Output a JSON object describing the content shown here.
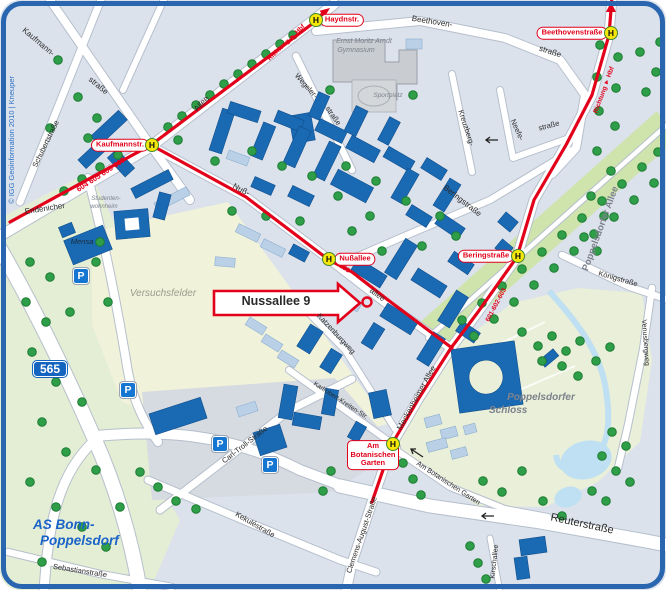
{
  "map": {
    "copyright": "© IGG Geoinformation 2010 | Kneuper",
    "callout": "Nussallee 9",
    "shield_565": "565",
    "h": "H",
    "parking": "P",
    "junction": [
      "AS Bonn-",
      "Poppelsdorf"
    ],
    "stops": {
      "haydnstr": "Haydnstr.",
      "beethovenstrasse": "Beethovenstraße",
      "kaufmannstr": "Kaufmannstr.",
      "nussallee": "Nußallee",
      "beringstrasse": "Beringstraße",
      "am_botanischen_garten": [
        "Am",
        "Botanischen",
        "Garten"
      ]
    },
    "routes": {
      "endenicher_lines": "604 605 606 607",
      "nussallee_line": "631",
      "meckenheimer_lines": "601-602-603",
      "direction_hbf_left": "Richtung ► Hbf",
      "direction_hbf_right": "Richtung ► Hbf"
    },
    "streets": {
      "kaufmann_1": "Kaufmann-",
      "kaufmann_2": "straße",
      "schubertstrasse": "Schubertstraße",
      "endenicher": "Endenicher",
      "endenicher_allee": "Allee",
      "beethoven_1": "Beethoven-",
      "beethoven_2": "straße",
      "wegeler_1": "Wegeler-",
      "wegeler_2": "straße",
      "kreuzbergweg": "Kreuzberg-",
      "neefe_1": "Neefe-",
      "neefe_2": "straße",
      "beringstrasse": "Beringstraße",
      "nuss_1": "Nuß-",
      "nuss_2": "allee",
      "katzenburgweg": "Katzenburgweg",
      "meckenheimer_allee": "Meckenheimer Allee",
      "karlrobert": "Karlrobert-Kreiten-Str.",
      "clemens_august": "Clemens-August-Straße",
      "carl_troll": "Carl-Troll-Straße",
      "kekulestrasse": "Kekuléstraße",
      "sebastianstrasse": "Sebastianstraße",
      "reuterstrasse": "Reuterstraße",
      "kirschallee": "Kirschallee",
      "koenigstrasse": "Königstraße",
      "venusbergweg": "Venusbergweg",
      "am_botanischen_garten": "Am Botanischen Garten",
      "poppelsdorfer_allee": "Poppelsdorfer  Allee"
    },
    "places": {
      "gymnasium_1": "Ernst Moritz Arndt",
      "gymnasium_2": "Gymnasium",
      "sportplatz": "Sportplatz",
      "mensa": "Mensa",
      "wohnheim_1": "Studenten-",
      "wohnheim_2": "wohnheim",
      "versuchsfelder": "Versuchsfelder",
      "schloss_1": "Poppelsdorfer",
      "schloss_2": "Schloss"
    },
    "colors": {
      "route_red": "#e2001a",
      "building_blue": "#1a6ab3",
      "building_pale": "#b9d0e7",
      "water_blue": "#bfe0f2",
      "park_green": "#e4eed4",
      "tree_green": "#2f9e48",
      "shield_blue": "#1565c0",
      "frame_blue": "#2a66b0"
    }
  }
}
